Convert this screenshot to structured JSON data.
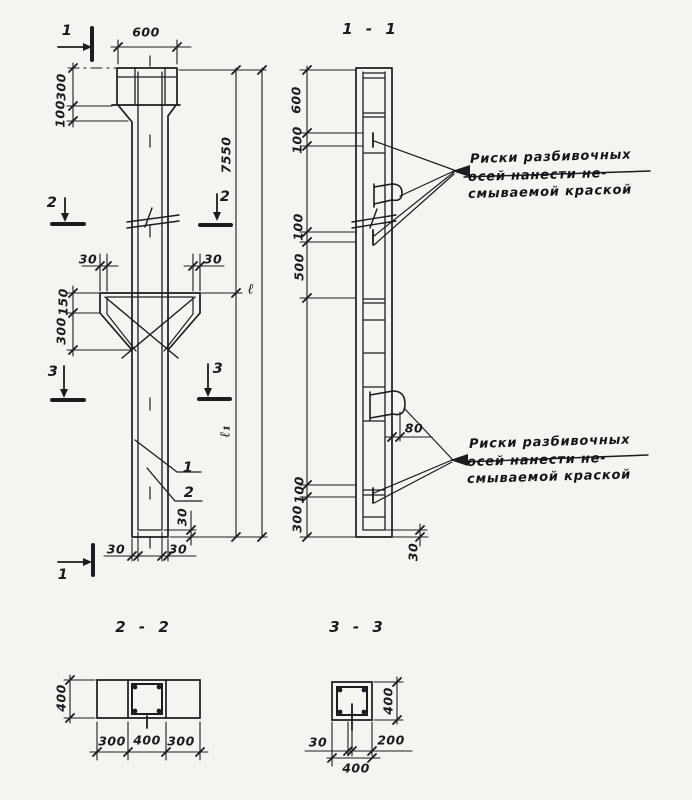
{
  "colors": {
    "paper": "#f5f4f0",
    "ink": "#1c1c1c"
  },
  "elevation": {
    "marker_1_top": "1",
    "marker_1_bottom": "1",
    "marker_2_left": "2",
    "marker_2_right": "2",
    "marker_3_left": "3",
    "marker_3_right": "3",
    "dim_width_top": "600",
    "dim_head_depth": "300",
    "dim_head_taper": "100",
    "dim_length_upper": "7550",
    "dim_length_total": "ℓ",
    "dim_length_lower": "ℓ₁",
    "dim_corbel_offset_left": "30",
    "dim_corbel_offset_right": "30",
    "dim_corbel_face": "150",
    "dim_corbel_slope": "300",
    "dim_cover_left": "30",
    "dim_cover_right": "30",
    "dim_cover_bottom": "30",
    "callout_rebar_1": "1",
    "callout_rebar_2": "2"
  },
  "section_1_1": {
    "title": "1 - 1",
    "dim_top": "600",
    "dim_mark_top": "100",
    "dim_mark_mid": "100",
    "dim_mid": "500",
    "dim_mark_bottom": "100",
    "dim_bottom": "300",
    "dim_loop": "80",
    "dim_cover_bottom": "30",
    "note_upper": {
      "line1": "Риски разбивочных",
      "line2": "осей нанести не-",
      "line3": "смываемой краской"
    },
    "note_lower": {
      "line1": "Риски разбивочных",
      "line2": "осей нанести не-",
      "line3": "смываемой краской"
    }
  },
  "section_2_2": {
    "title": "2 - 2",
    "dim_height": "400",
    "dim_left": "300",
    "dim_center": "400",
    "dim_right": "300"
  },
  "section_3_3": {
    "title": "3 - 3",
    "dim_height": "400",
    "dim_offset": "30",
    "dim_edge": "200",
    "dim_width": "400"
  }
}
